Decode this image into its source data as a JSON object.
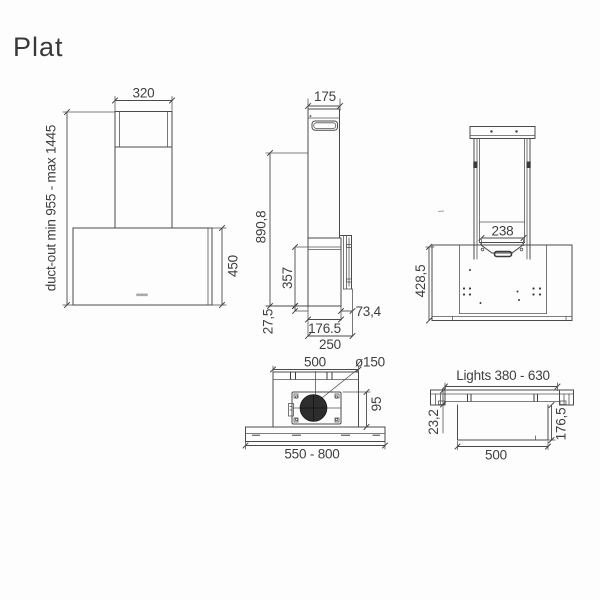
{
  "title": "Plat",
  "views": {
    "front": {
      "chimney_width": "320",
      "duct_out_range": "duct-out min 955 - max 1445",
      "body_height": "450"
    },
    "side": {
      "chimney_depth": "175",
      "overall_height": "890,8",
      "body_height": "357",
      "bottom_offset": "27,5",
      "wall_gap": "73,4",
      "body_depth": "176.5",
      "total_depth": "250"
    },
    "rear": {
      "bracket_width": "238",
      "mounting_height": "428,5"
    },
    "bottom": {
      "housing_width": "500",
      "duct_diameter": "ø150",
      "housing_depth": "95",
      "body_width_range": "550 - 800"
    },
    "section": {
      "lights_width_range": "Lights 380 - 630",
      "panel_thickness": "23,2",
      "box_depth": "176,5",
      "box_width": "500"
    }
  }
}
